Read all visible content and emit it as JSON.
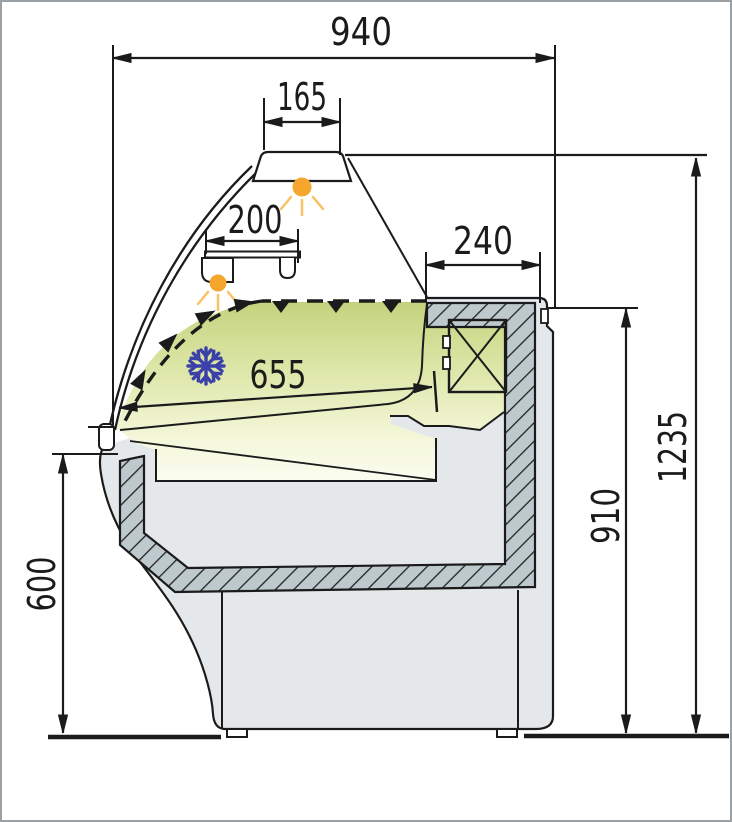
{
  "meta": {
    "drawing_type": "technical cross-section diagram",
    "subject": "refrigerated serve-over display counter",
    "units_note": "dimension values as printed on drawing"
  },
  "dimensions": {
    "overall_width": "940",
    "canopy_lamp_width": "165",
    "shelf_depth": "200",
    "rear_top_depth": "240",
    "deck_depth": "655",
    "overall_height": "1235",
    "rear_height": "910",
    "front_height": "600"
  },
  "icons": {
    "snowflake": "snowflake-icon",
    "canopy_lamp": "lamp-glow-icon",
    "shelf_lamp": "lamp-glow-icon"
  },
  "colors": {
    "line": "#1b1b1b",
    "display_area_gradient_top": "#c3d17a",
    "display_area_gradient_bottom": "#fcfdf3",
    "insulation_fill": "#bec9ce",
    "insulation_stripe": "#222222",
    "body_fill": "#e4e8ea",
    "lamp_orange": "#f5a62c",
    "lamp_ray_orange": "#f8c165",
    "snowflake_blue": "#3a41a8",
    "page_border": "#9aa0a3",
    "background": "#ffffff"
  }
}
